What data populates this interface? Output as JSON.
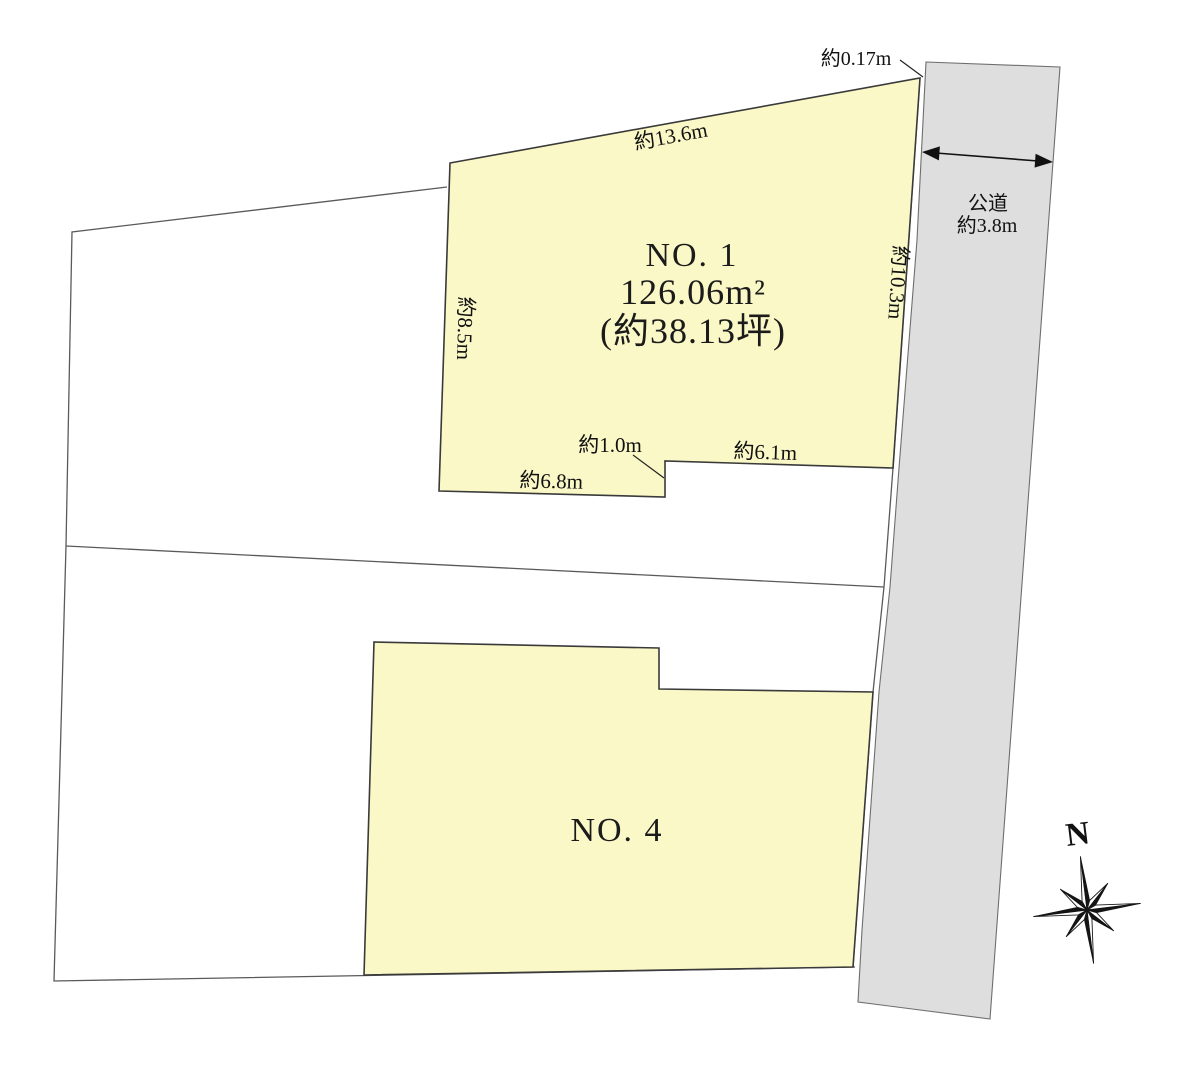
{
  "plots": {
    "no1": {
      "label": "NO. 1",
      "area_m2": "126.06m²",
      "area_tsubo": "(約38.13坪)"
    },
    "no4": {
      "label": "NO. 4"
    }
  },
  "dimensions": {
    "top_edge": "約13.6m",
    "left_edge": "約8.5m",
    "right_edge": "約10.3m",
    "setback": "約0.17m",
    "bottom_left_edge": "約6.8m",
    "step": "約1.0m",
    "bottom_right_edge": "約6.1m"
  },
  "road": {
    "name": "公道",
    "width": "約3.8m"
  },
  "compass": {
    "north": "N"
  },
  "colors": {
    "parcel_fill": "#FAF8C6",
    "road_fill": "#DEDEDE",
    "outline": "#3A3A3A",
    "text": "#111111"
  }
}
